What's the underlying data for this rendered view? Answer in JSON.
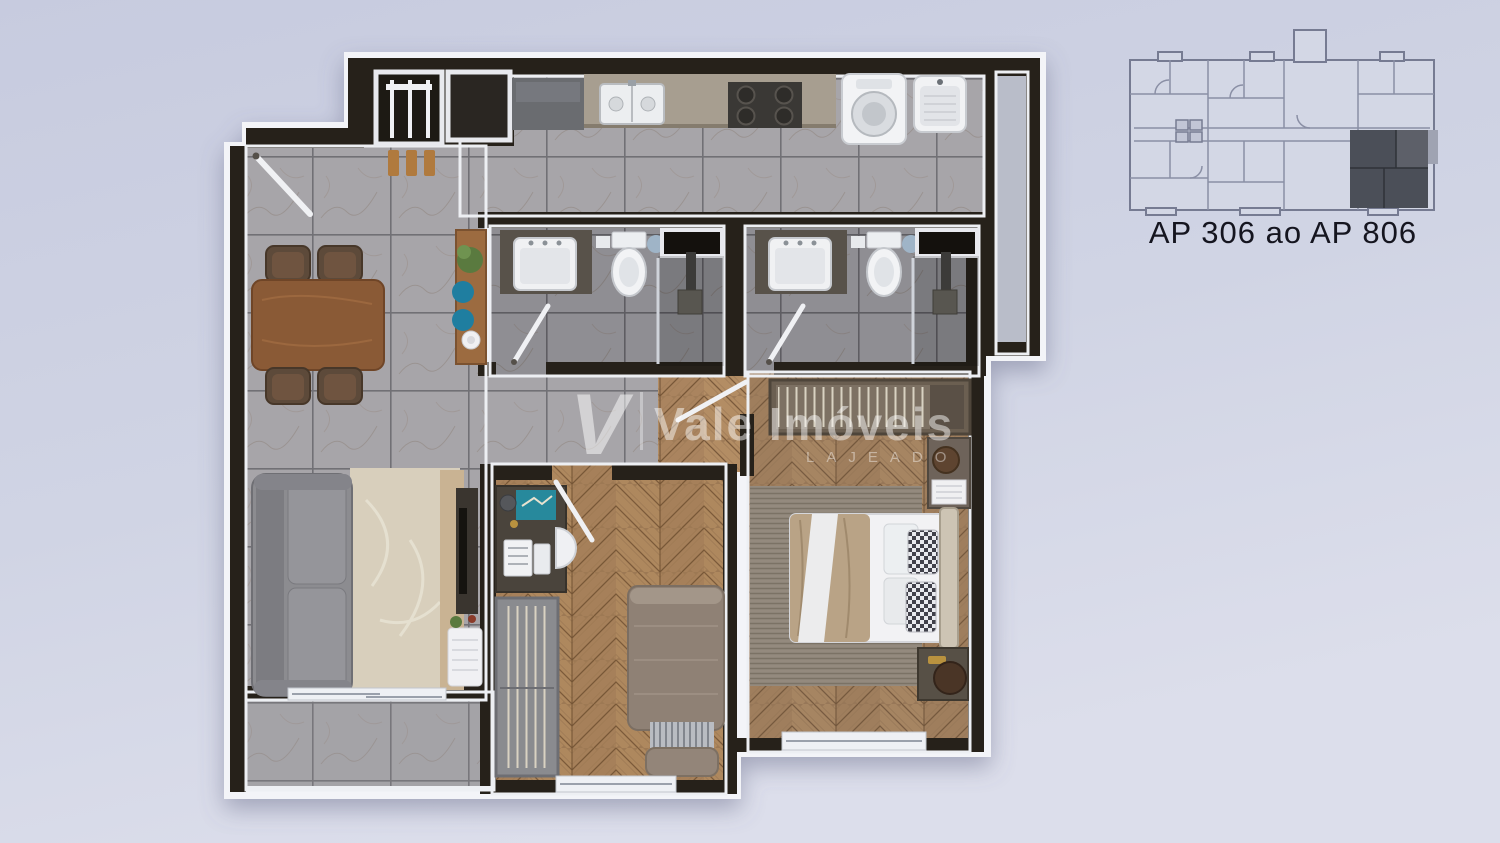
{
  "canvas": {
    "width": 1500,
    "height": 843
  },
  "colors": {
    "background": "#ced2e3",
    "wall": "#26211a",
    "white_rim": "#f3f4f8",
    "tile_floor": "#a7a5a9",
    "bath_floor": "#8f8e93",
    "wood_floor": "#a07c58",
    "shaft": "#b9bdc9",
    "counter": "#a79e90",
    "sofa": "#8c8c90",
    "living_rug": "#d8cfbc",
    "master_rug": "#8d8478",
    "dining_table": "#8a5a36",
    "accent_teal": "#1f7ea0",
    "plant_green": "#5a7a3f",
    "fixture_white": "#f2f3f5"
  },
  "watermark": {
    "logo_letter": "V",
    "brand": "Vale Imóveis",
    "city": "LAJEADO",
    "color": "#ffffff"
  },
  "key_plan": {
    "caption": "AP 306 ao AP 806",
    "line_color": "#767b92",
    "fill_color": "#d3d7e5",
    "highlight_color": "#4b4f58",
    "highlight_light": "#5d6069",
    "text_color": "#15151f"
  }
}
